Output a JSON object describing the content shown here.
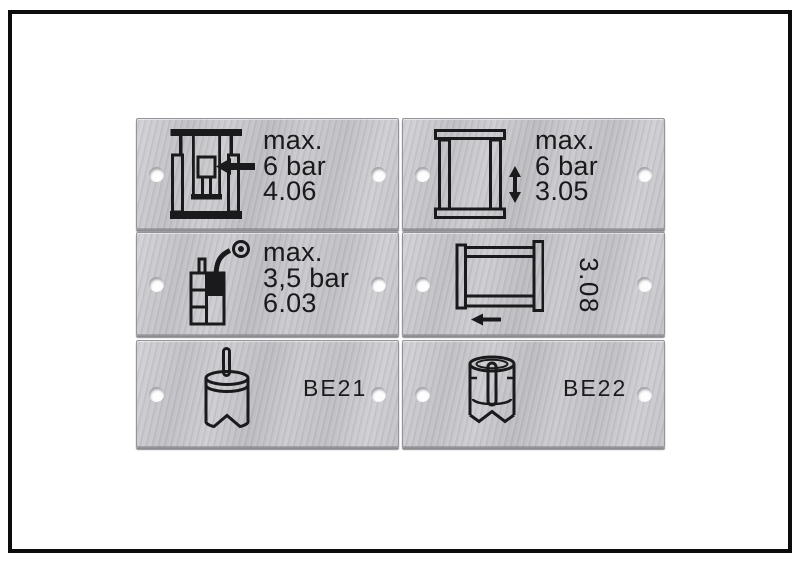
{
  "scene": {
    "description": "six engraved brushed-aluminium machine labels in a white framed panel",
    "background": "#ffffff",
    "frame_border_color": "#0c0c0c"
  },
  "colors": {
    "plate_metal": "#c6c6ca",
    "plate_edge": "#94949a",
    "ink": "#1a1a1c",
    "hole": "#fdfdfd"
  },
  "plates": [
    {
      "position": "row-1-left",
      "icon": "press-ram-left-arrow-icon",
      "lines": [
        "max.",
        "6 bar",
        "4.06"
      ]
    },
    {
      "position": "row-1-right",
      "icon": "lift-frame-vertical-arrow-icon",
      "lines": [
        "max.",
        "6 bar",
        "3.05"
      ]
    },
    {
      "position": "row-2-left",
      "icon": "filler-hose-gauge-icon",
      "lines": [
        "max.",
        "3,5 bar",
        "6.03"
      ]
    },
    {
      "position": "row-2-right",
      "icon": "carriage-left-arrow-icon",
      "label": "3.08",
      "label_orientation": "rotated-90"
    },
    {
      "position": "row-3-left",
      "icon": "magazine-cylinder-rod-icon",
      "label": "BE21"
    },
    {
      "position": "row-3-right",
      "icon": "magazine-cylinder-cutaway-icon",
      "label": "BE22"
    }
  ]
}
